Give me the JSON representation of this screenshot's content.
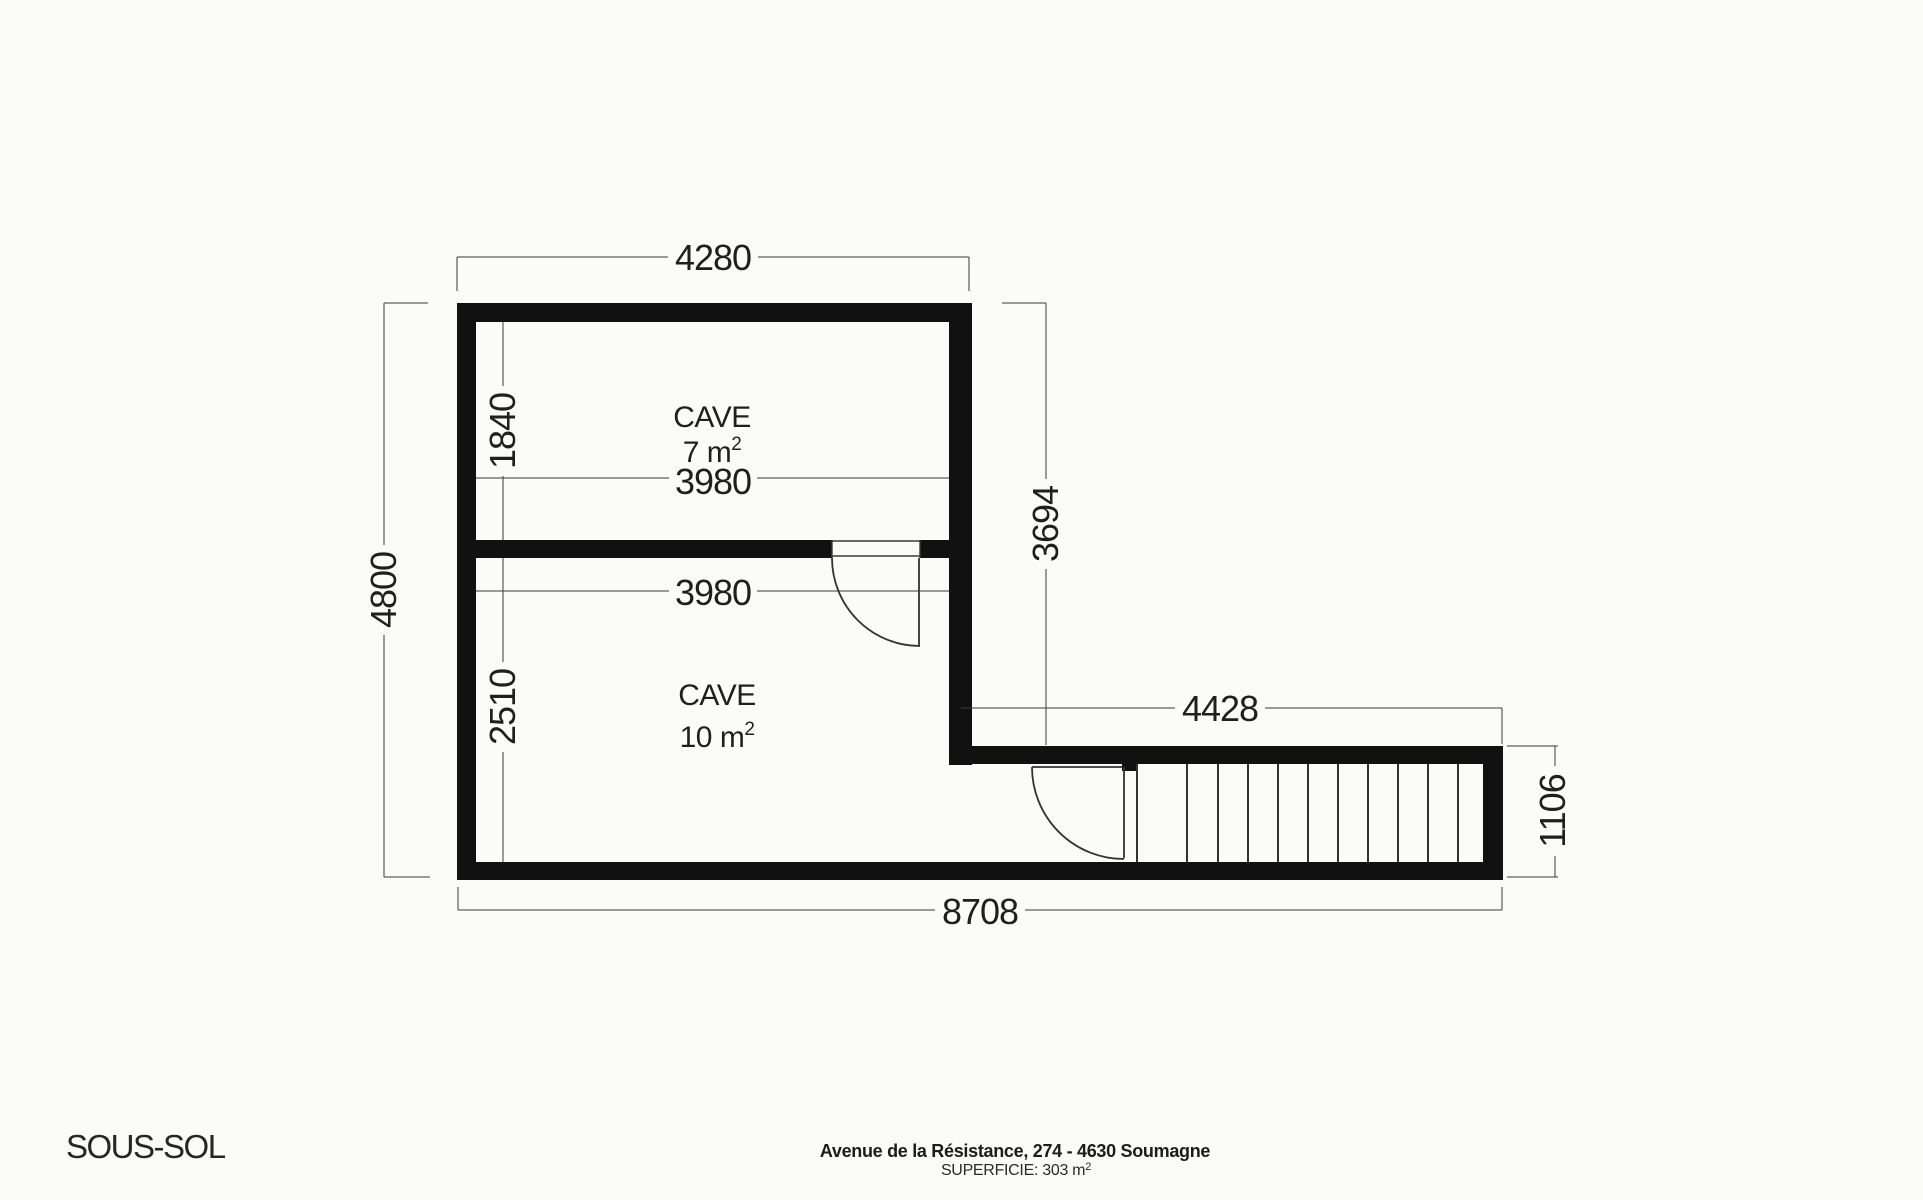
{
  "page": {
    "floor_label": "SOUS-SOL",
    "address": "Avenue de la Résistance, 274 - 4630 Soumagne",
    "superficie_label": "SUPERFICIE: 303 m",
    "superficie_sup": "2"
  },
  "plan": {
    "rooms": [
      {
        "name": "CAVE",
        "area": "7 m",
        "area_sup": "2"
      },
      {
        "name": "CAVE",
        "area": "10 m",
        "area_sup": "2"
      }
    ],
    "dimensions": {
      "top_width": "4280",
      "overall_height": "4800",
      "cave7_height": "1840",
      "cave7_width": "3980",
      "cave10_width": "3980",
      "cave10_height": "2510",
      "right_height": "3694",
      "stair_width": "4428",
      "stair_height": "1106",
      "overall_width": "8708"
    },
    "colors": {
      "wall": "#111111",
      "line": "#333333",
      "text": "#1f1f1f",
      "background": "#fbfbfa"
    }
  }
}
